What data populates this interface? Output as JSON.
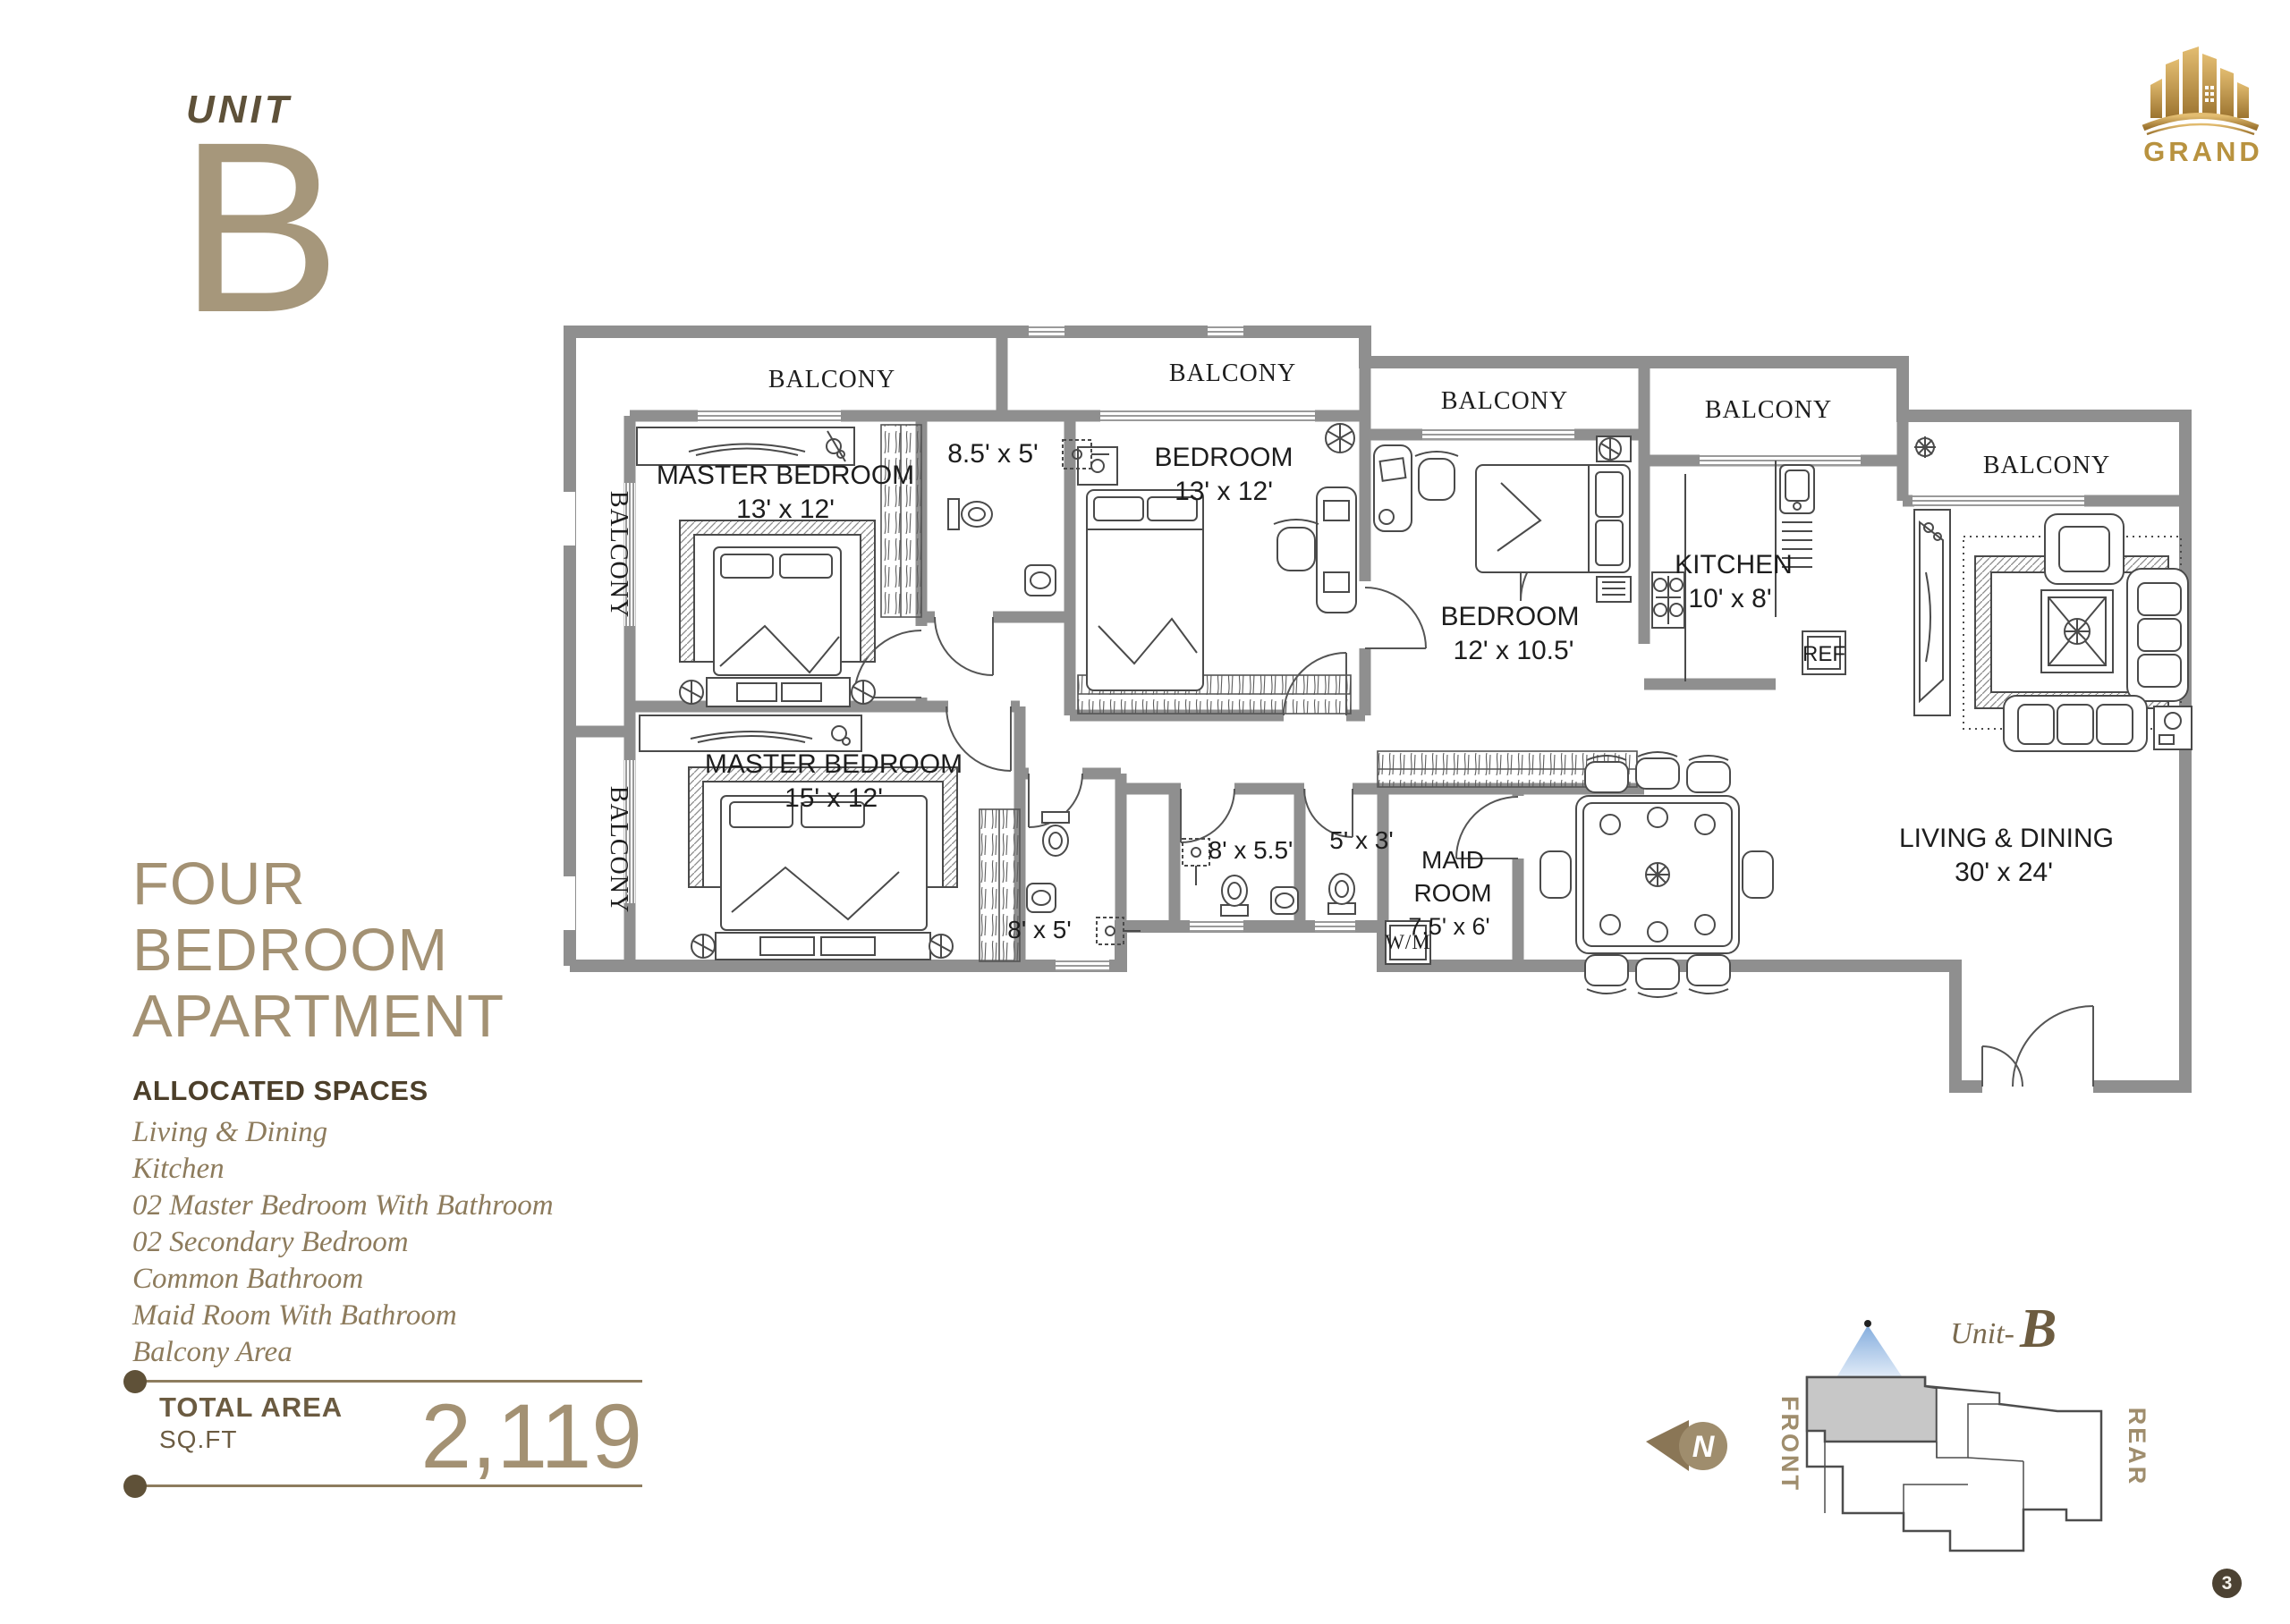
{
  "header": {
    "unit_label": "UNIT",
    "unit_letter": "B"
  },
  "logo": {
    "text": "GRAND"
  },
  "title": {
    "line1": "FOUR",
    "line2": "BEDROOM",
    "line3": "APARTMENT"
  },
  "allocated": {
    "heading": "ALLOCATED SPACES",
    "items": [
      "Living & Dining",
      "Kitchen",
      "02 Master Bedroom With Bathroom",
      "02 Secondary Bedroom",
      "Common Bathroom",
      "Maid Room With Bathroom",
      "Balcony Area"
    ]
  },
  "total": {
    "label": "TOTAL AREA",
    "unit": "SQ.FT",
    "value": "2,119"
  },
  "plan": {
    "balcony_label": "BALCONY",
    "rooms": {
      "master1": {
        "name": "MASTER BEDROOM",
        "dim": "13' x 12'"
      },
      "master2": {
        "name": "MASTER BEDROOM",
        "dim": "15' x 12'"
      },
      "bedroom1": {
        "name": "BEDROOM",
        "dim": "13' x 12'"
      },
      "bedroom2": {
        "name": "BEDROOM",
        "dim": "12' x 10.5'"
      },
      "kitchen": {
        "name": "KITCHEN",
        "dim": "10' x 8'"
      },
      "living": {
        "name": "LIVING & DINING",
        "dim": "30' x 24'"
      },
      "maid": {
        "line1": "MAID",
        "line2": "ROOM",
        "dim": "7.5' x 6'"
      },
      "bath_85x5": "8.5' x 5'",
      "bath_8x5": "8' x 5'",
      "bath_8x55": "8' x 5.5'",
      "bath_5x3": "5' x 3'",
      "ref": "REF",
      "wm": "W/M"
    }
  },
  "locator": {
    "unit_prefix": "Unit-",
    "unit_letter": "B",
    "front": "FRONT",
    "rear": "REAR",
    "north": "N"
  },
  "page": {
    "number": "3"
  },
  "colors": {
    "wall": "#8f8f8f",
    "tan": "#a39173",
    "dark_brown": "#4c3f2a",
    "gold": "#b8923f",
    "plan_text": "#1d1d1d",
    "highlight_unit": "#c7c7c7"
  }
}
